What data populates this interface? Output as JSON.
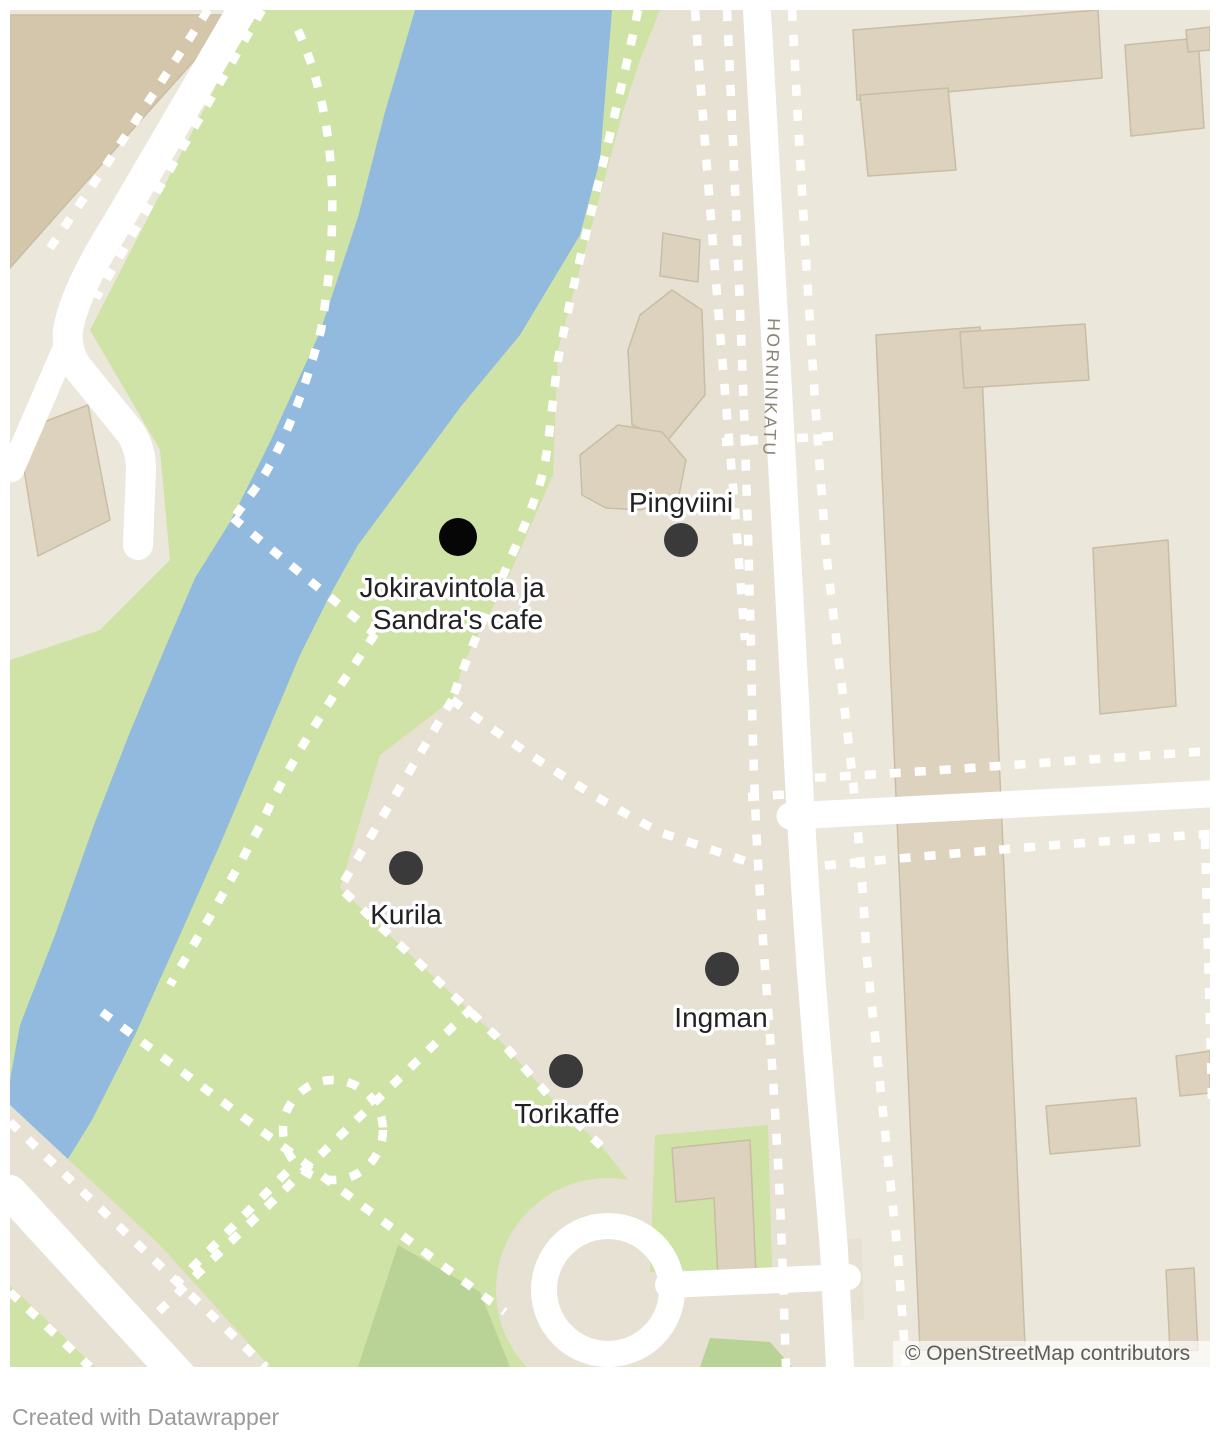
{
  "colors": {
    "page_bg": "#ffffff",
    "land": "#e7e1d4",
    "block": "#ebe7db",
    "green": "#cee3a5",
    "green_dark": "#b9d295",
    "river": "#92bade",
    "building": "#dcd2bd",
    "building_stroke": "#c9bda3",
    "building_brown": "#d3c6ab",
    "road": "#ffffff",
    "path": "#ffffff",
    "label": "#222222",
    "label_halo": "#ffffff",
    "street_label": "#8b8577",
    "attribution_text": "#5d5d5d",
    "attribution_bg": "rgba(255,255,255,0.65)",
    "credit_text": "#9b9b9b"
  },
  "map": {
    "street_label": "HORNINKATU",
    "attribution": "© OpenStreetMap contributors",
    "markers": [
      {
        "id": "jokiravintola",
        "label": "Jokiravintola ja Sandra's cafe",
        "lines": [
          "Jokiravintola ja",
          "Sandra's cafe"
        ],
        "dot_transform": "translate(458,537)",
        "dot_radius": "19",
        "dot_color": "#060606",
        "label_transform": "translate(456,597)"
      },
      {
        "id": "pingviini",
        "label": "Pingviini",
        "dot_transform": "translate(681,540)",
        "dot_radius": "17",
        "dot_color": "#3a3a3a",
        "label_transform": "translate(681,512)"
      },
      {
        "id": "kurila",
        "label": "Kurila",
        "dot_transform": "translate(406,868)",
        "dot_radius": "17",
        "dot_color": "#3a3a3a",
        "label_transform": "translate(406,924)"
      },
      {
        "id": "ingman",
        "label": "Ingman",
        "dot_transform": "translate(722,969)",
        "dot_radius": "17",
        "dot_color": "#3a3a3a",
        "label_transform": "translate(721,1027)"
      },
      {
        "id": "torikaffe",
        "label": "Torikaffe",
        "dot_transform": "translate(566,1071)",
        "dot_radius": "17",
        "dot_color": "#3a3a3a",
        "label_transform": "translate(567,1123)"
      }
    ]
  },
  "footer": {
    "credit": "Created with Datawrapper"
  }
}
